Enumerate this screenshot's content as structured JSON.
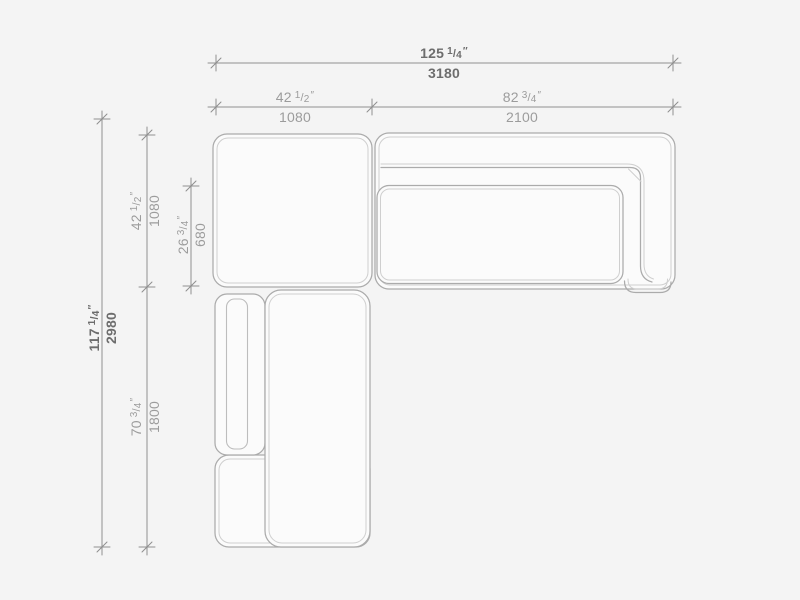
{
  "colors": {
    "background": "#f4f4f4",
    "module_fill": "#fbfbfb",
    "outline_strong": "#ababab",
    "outline_light": "#cfcfcf",
    "dim_line": "#8f8f8f",
    "text_strong": "#6d6d6d",
    "text_light": "#9c9c9c"
  },
  "symbols": {
    "fraction_slash": "/",
    "inch_mark": "″"
  },
  "dimensions": {
    "overall_width": {
      "inches_whole": "125",
      "inches_num": "1",
      "inches_den": "4",
      "millimeters": "3180"
    },
    "left_module_width": {
      "inches_whole": "42",
      "inches_num": "1",
      "inches_den": "2",
      "millimeters": "1080"
    },
    "right_module_width": {
      "inches_whole": "82",
      "inches_num": "3",
      "inches_den": "4",
      "millimeters": "2100"
    },
    "overall_depth": {
      "inches_whole": "117",
      "inches_num": "1",
      "inches_den": "4",
      "millimeters": "2980"
    },
    "upper_module_depth": {
      "inches_whole": "42",
      "inches_num": "1",
      "inches_den": "2",
      "millimeters": "1080"
    },
    "seat_depth": {
      "inches_whole": "26",
      "inches_num": "3",
      "inches_den": "4",
      "millimeters": "680"
    },
    "chaise_module_depth": {
      "inches_whole": "70",
      "inches_num": "3",
      "inches_den": "4",
      "millimeters": "1800"
    }
  }
}
